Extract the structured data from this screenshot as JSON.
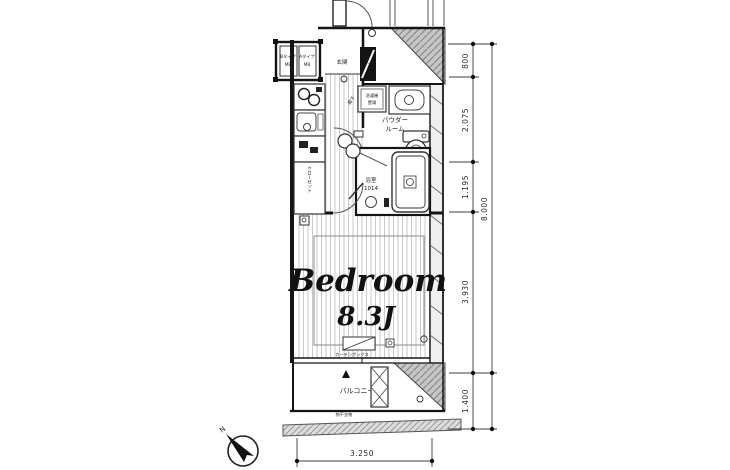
{
  "plan": {
    "rooms": {
      "bedroom_name": "Bedroom",
      "bedroom_size": "8.3J",
      "balcony": "バルコニー",
      "powder_line1": "パウダー",
      "powder_line2": "ルーム",
      "bath_line1": "浴室",
      "bath_line2": "1014",
      "entrance": "玄関",
      "hallway": "廊下",
      "closet": "クローゼット",
      "shoe_box": "下足入",
      "laundry_line1": "洗濯機",
      "laundry_line2": "置場"
    },
    "fixtures": {
      "curtain_box": "カーテンボックス",
      "drying_fixture": "物干金物"
    },
    "meter_boxes": {
      "left_line1": "Bタイプ",
      "left_line2": "MB",
      "right_line1": "Aタイプ",
      "right_line2": "MB"
    },
    "compass": {
      "north": "N"
    }
  },
  "dimensions": {
    "right_segments": [
      "800",
      "2.075",
      "1.195",
      "3.930",
      "1.400"
    ],
    "right_total": "8.000",
    "bottom_width": "3.250"
  },
  "colors": {
    "wall": "#141414",
    "hatch_fill": "#c6c6c6",
    "hatch_line": "#8b8b8b",
    "floor_line": "#c9c9c9",
    "dim_line": "#3c3c3c"
  }
}
